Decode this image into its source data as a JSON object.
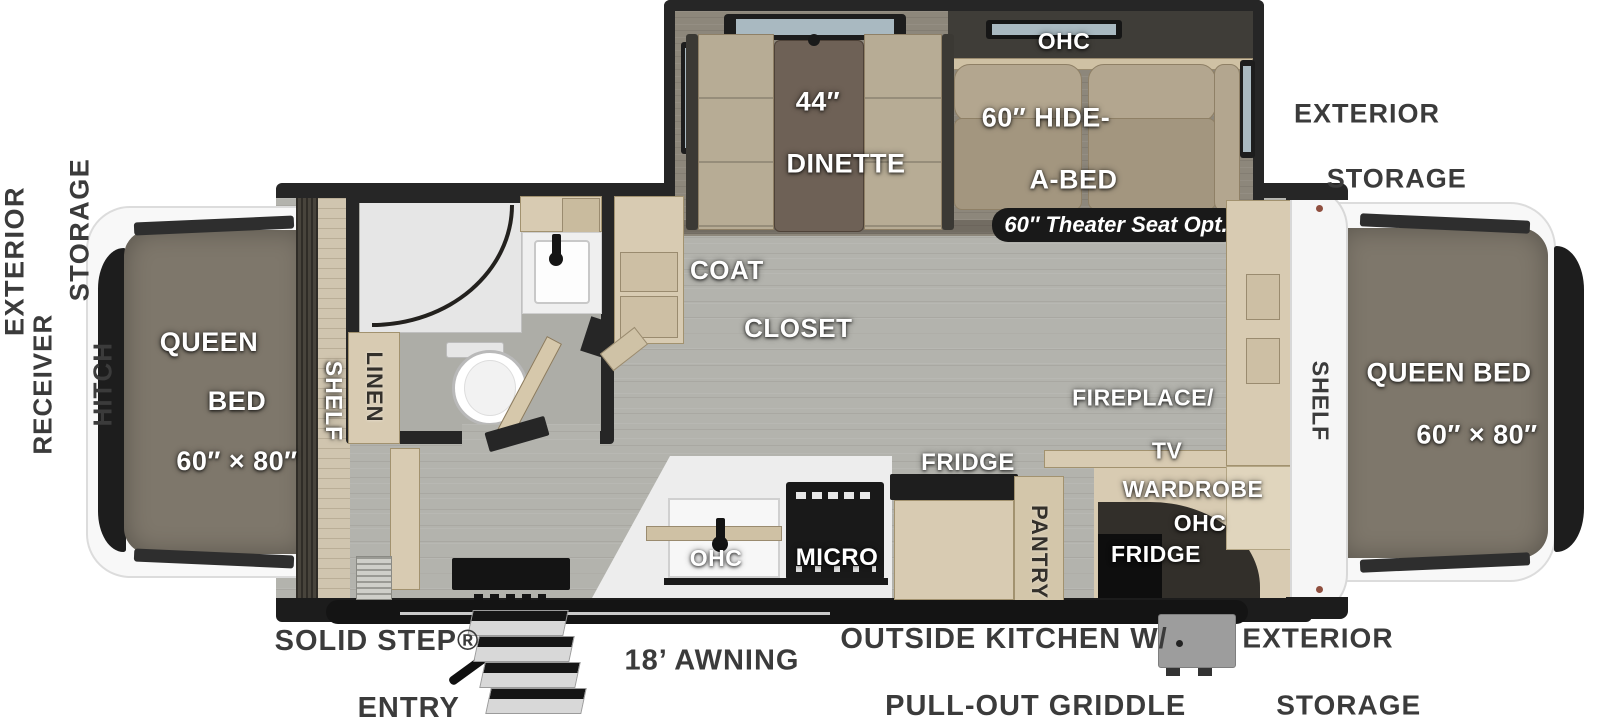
{
  "plan": {
    "slide": {
      "ohc": "OHC",
      "dinette_line1": "44″",
      "dinette_line2": "DINETTE",
      "hideabed_line1": "60″ HIDE-",
      "hideabed_line2": "A-BED",
      "theater_option": "60″ Theater Seat Opt."
    },
    "bedroom_left": {
      "line1": "QUEEN",
      "line2": "BED",
      "line3": "60″ × 80″",
      "shelf": "SHELF"
    },
    "bedroom_right": {
      "line1": "QUEEN BED",
      "line2": "60″ × 80″",
      "shelf": "SHELF"
    },
    "bath": {
      "linen": "LINEN"
    },
    "closet": {
      "line1": "COAT",
      "line2": "CLOSET"
    },
    "kitchen": {
      "ohc": "OHC",
      "micro": "MICRO",
      "fridge": "FRIDGE",
      "pantry": "PANTRY"
    },
    "entertainment": {
      "fireplace_line1": "FIREPLACE/",
      "fireplace_line2": "TV",
      "wardrobe": "WARDROBE",
      "ohc": "OHC",
      "fridge": "FRIDGE"
    },
    "exterior": {
      "left_storage_line1": "EXTERIOR",
      "left_storage_line2": "STORAGE",
      "hitch_line1": "2″",
      "hitch_line2": "RECEIVER",
      "hitch_line3": "HITCH",
      "front_storage_line1": "EXTERIOR",
      "front_storage_line2": "STORAGE",
      "rear_storage_line1": "EXTERIOR",
      "rear_storage_line2": "STORAGE",
      "entry_line1": "SOLID STEP®",
      "entry_line2": "ENTRY",
      "awning": "18’ AWNING",
      "outside_kitchen_line1": "OUTSIDE KITCHEN W/",
      "outside_kitchen_line2": "PULL-OUT GRIDDLE"
    },
    "colors": {
      "wall": "#262626",
      "floor_main": "#b3b3ad",
      "floor_slide": "#8d877b",
      "cabinet": "#d8cbb2",
      "mattress": "#7e776b",
      "sofa": "#a99c86",
      "dinette_table": "#6e6156",
      "badge_bg": "#191919",
      "exterior_label": "#3b3b3b"
    }
  }
}
